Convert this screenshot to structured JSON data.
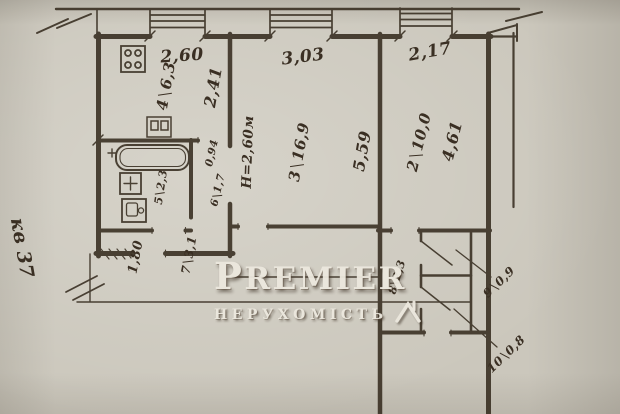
{
  "plan": {
    "apartment_label": "кв 37",
    "ceiling_height_note": "Н=2,60м",
    "rooms": {
      "kitchen": {
        "number": "4",
        "area": "6,3"
      },
      "living_room": {
        "number": "3",
        "area": "16,9"
      },
      "bedroom": {
        "number": "2",
        "area": "10,0"
      },
      "bathroom": {
        "number": "5",
        "area": "2,3"
      },
      "corridor": {
        "number": "6",
        "area": "1,7"
      },
      "hall": {
        "number": "7",
        "area": "3,1"
      },
      "corridor_2": {
        "number": "8",
        "area": "2,3"
      },
      "closet_1": {
        "number": "9",
        "area": "0,9"
      },
      "closet_2": {
        "number": "10",
        "area": "0,8"
      }
    },
    "dimensions": {
      "kitchen_width": "2,60",
      "kitchen_depth": "2,41",
      "living_width": "3,03",
      "living_depth": "5,59",
      "bedroom_width": "2,17",
      "bedroom_depth": "4,61",
      "corridor_width": "0,94",
      "hall_width": "1,80"
    },
    "watermark": {
      "brand": "PREMIER",
      "subtitle": "НЕРУХОМІСТЬ"
    }
  }
}
